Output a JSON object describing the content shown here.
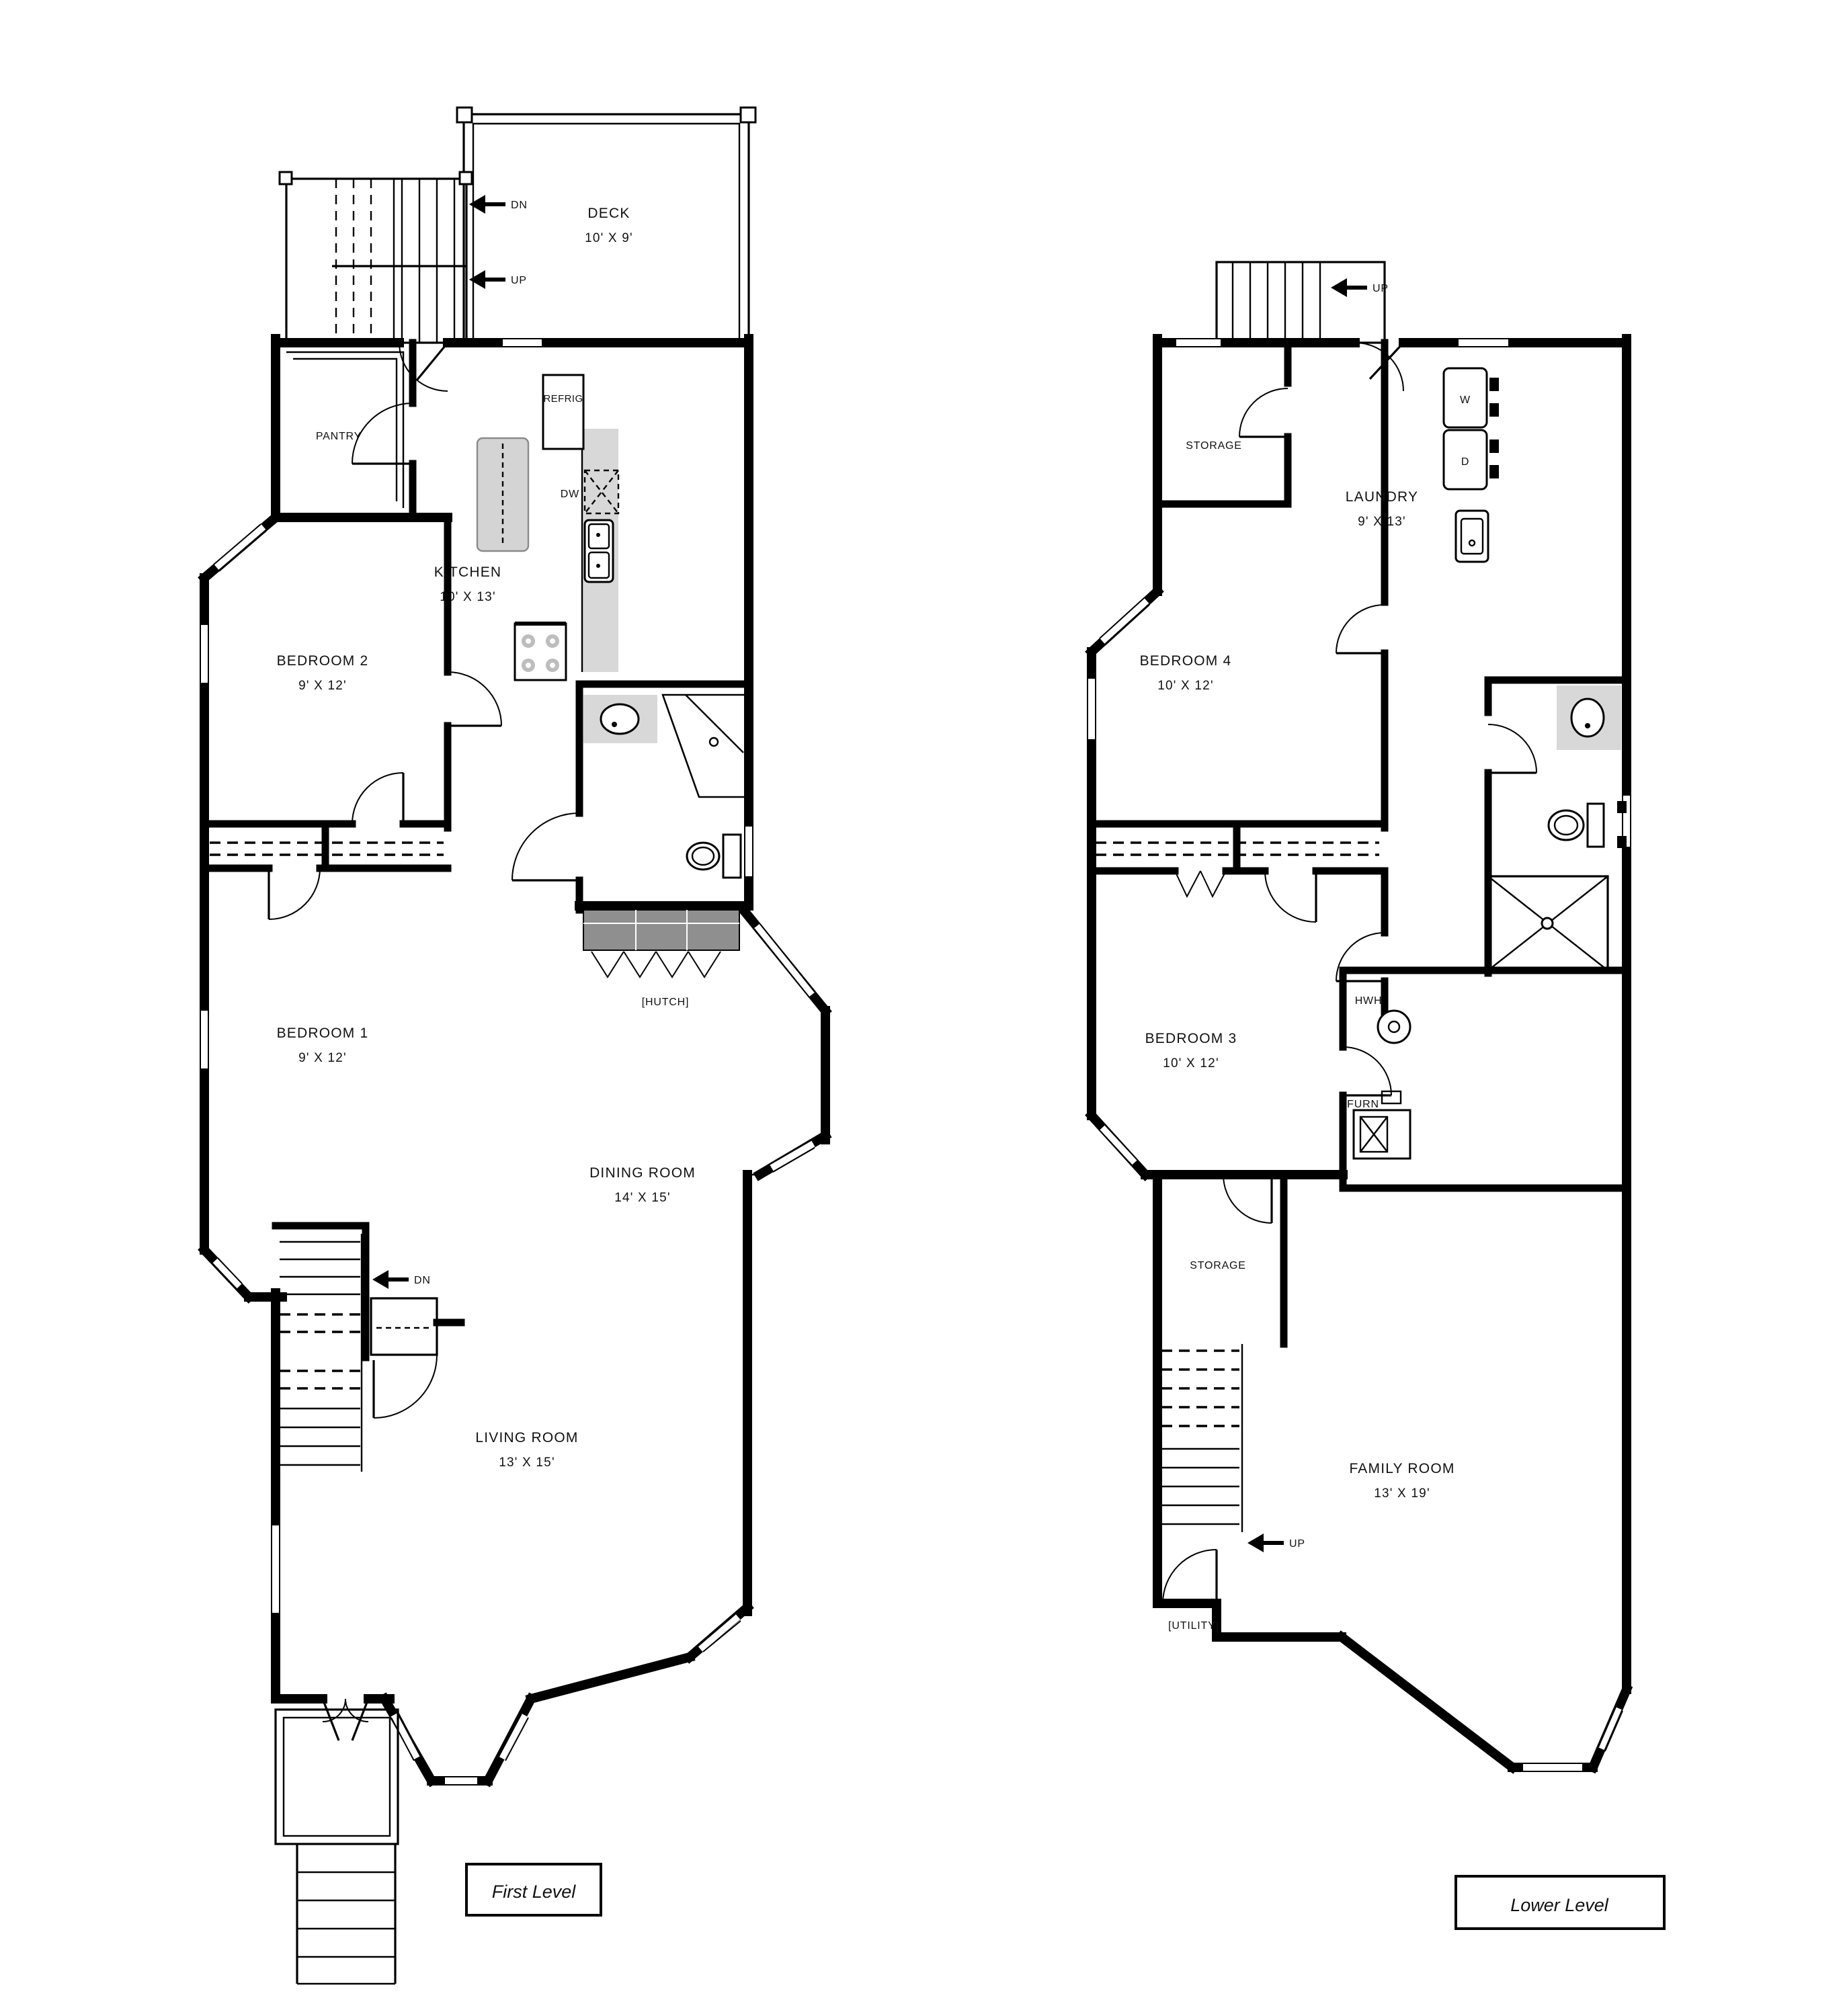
{
  "first_level": {
    "caption": "First Level",
    "deck": {
      "name": "DECK",
      "size": "10' X 9'"
    },
    "kitchen": {
      "name": "KITCHEN",
      "size": "10' X 13'"
    },
    "bedroom2": {
      "name": "BEDROOM 2",
      "size": "9' X 12'"
    },
    "bedroom1": {
      "name": "BEDROOM 1",
      "size": "9' X 12'"
    },
    "dining": {
      "name": "DINING ROOM",
      "size": "14' X 15'"
    },
    "living": {
      "name": "LIVING ROOM",
      "size": "13' X 15'"
    },
    "pantry_label": "PANTRY",
    "refrig_label": "REFRIG",
    "dw_label": "DW",
    "hutch_label": "[HUTCH]",
    "arrows": {
      "deck_dn": "DN",
      "deck_up": "UP",
      "stairs_dn": "DN"
    }
  },
  "lower_level": {
    "caption": "Lower Level",
    "storage_upper": "STORAGE",
    "storage_lower": "STORAGE",
    "laundry": {
      "name": "LAUNDRY",
      "size": "9' X 13'"
    },
    "bedroom4": {
      "name": "BEDROOM 4",
      "size": "10' X 12'"
    },
    "bedroom3": {
      "name": "BEDROOM 3",
      "size": "10' X 12'"
    },
    "family": {
      "name": "FAMILY ROOM",
      "size": "13' X 19'"
    },
    "washer_label": "W",
    "dryer_label": "D",
    "hwh_label": "HWH",
    "furn_label": "FURN",
    "utility_label": "[UTILITY]",
    "arrows": {
      "up_top": "UP",
      "up_bottom": "UP"
    }
  },
  "colors": {
    "wall": "#000000",
    "counter": "#d8d8d8",
    "hutch": "#8f8f8f",
    "background": "#ffffff"
  }
}
